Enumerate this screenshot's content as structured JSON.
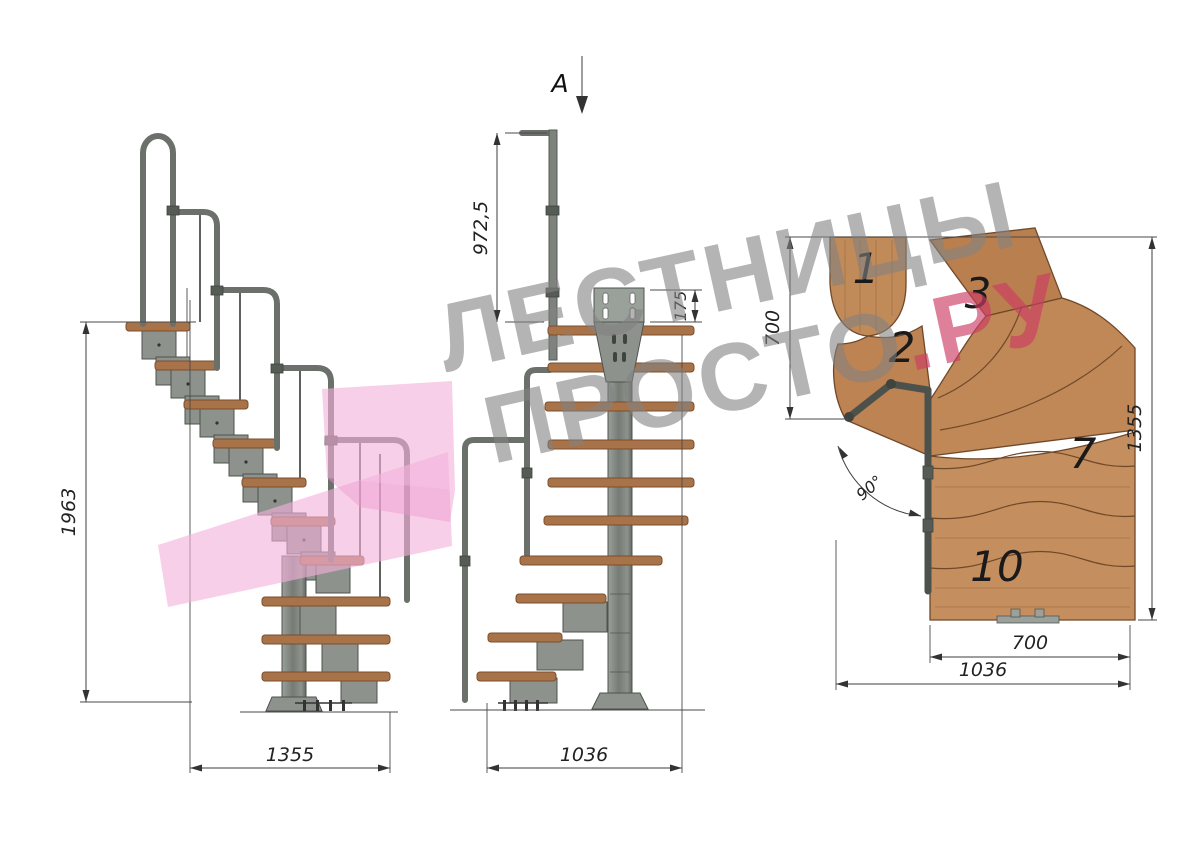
{
  "watermark": {
    "line1": "ЛЕСТНИЦЫ",
    "line2_main": "ПРОСТО",
    "line2_accent": ".РУ"
  },
  "side_view": {
    "height_label": "1963",
    "width_label": "1355"
  },
  "front_view": {
    "section_label": "A",
    "handrail_height_label": "972,5",
    "plate_height_label": "175",
    "width_label": "1036"
  },
  "plan_view": {
    "top_run_label": "700",
    "height_label": "1355",
    "tread_length_label": "700",
    "width_label": "1036",
    "angle_label": "90°",
    "tread_numbers": [
      "1",
      "2",
      "3",
      "7",
      "10"
    ]
  },
  "colors": {
    "wood_plan": "#c18a59",
    "wood_side": "#a9734a",
    "metal": "#8d928c",
    "metal_dark": "#565b56",
    "handrail": "#6b706b",
    "dimension": "#3c3c3c",
    "watermark_gray": "#989898",
    "watermark_accent": "#cd3c64",
    "logo_pink": "#f4b2dc"
  }
}
